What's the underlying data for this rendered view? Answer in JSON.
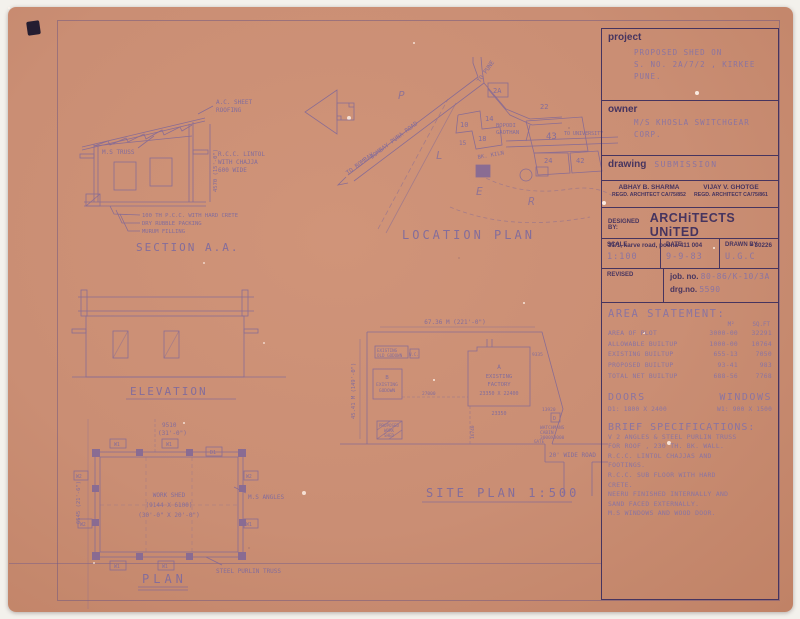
{
  "title_block": {
    "project": {
      "label": "project",
      "lines": [
        "PROPOSED SHED ON",
        "S. NO. 2A/7/2 , KIRKEE",
        "PUNE."
      ]
    },
    "owner": {
      "label": "owner",
      "lines": [
        "M/S KHOSLA SWITCHGEAR",
        "CORP."
      ]
    },
    "drawing": {
      "label": "drawing",
      "value": "SUBMISSION"
    },
    "architects": [
      {
        "name": "ABHAY B. SHARMA",
        "reg": "REGD. ARCHITECT CA/75/852"
      },
      {
        "name": "VIJAY V. GHOTGE",
        "reg": "REGD. ARCHITECT CA/75/861"
      }
    ],
    "designed_by": {
      "label": "DESIGNED BY:",
      "firm": "ARCHiTECTS UNiTED",
      "address": "31/1, karve road, poona 411 004",
      "phone": "• 30226"
    },
    "scale": {
      "label": "SCALE",
      "value": "1:100"
    },
    "date": {
      "label": "DATE",
      "value": "9-9-83"
    },
    "drawn_by": {
      "label": "DRAWN BY",
      "value": "U.G.C"
    },
    "revised_label": "REVISED",
    "job_no": {
      "label": "job. no.",
      "value": "80-86/K-10/3A"
    },
    "drg_no": {
      "label": "drg.no.",
      "value": "5590"
    }
  },
  "area_statement": {
    "title": "AREA STATEMENT:",
    "col_m2": "M²",
    "col_sqft": "SQ.FT",
    "rows": [
      {
        "label": "AREA OF PLOT",
        "m2": "3000-00",
        "sqft": "32291"
      },
      {
        "label": "ALLOWABLE BUILTUP",
        "m2": "1000-00",
        "sqft": "10764"
      },
      {
        "label": "EXISTING BUILTUP",
        "m2": "655-13",
        "sqft": "7050"
      },
      {
        "label": "PROPOSED BUILTUP",
        "m2": "93-41",
        "sqft": "983"
      },
      {
        "label": "TOTAL NET BUILTUP",
        "m2": "688-56",
        "sqft": "7768"
      }
    ]
  },
  "doors_windows": {
    "doors_title": "DOORS",
    "windows_title": "WINDOWS",
    "door_spec": "D1: 1800 X 2400",
    "window_spec": "W1: 900 X 1500"
  },
  "brief_specs": {
    "title": "BRIEF SPECIFICATIONS:",
    "lines": [
      "V 2 ANGLES & STEEL PURLIN TRUSS",
      "FOR ROOF , 230 TH. BK. WALL.",
      "R.C.C. LINTOL CHAJJAS AND",
      "FOOTINGS.",
      "R.C.C. SUB FLOOR WITH HARD",
      "CRETE.",
      "NEERU FINISHED INTERNALLY AND",
      "SAND FACED EXTERNALLY.",
      "M.S WINDOWS AND WOOD DOOR."
    ]
  },
  "drawings": {
    "section": {
      "title": "SECTION A.A.",
      "roofing": [
        "A.C. SHEET",
        "ROOFING"
      ],
      "truss": "M.S TRUSS",
      "lintol": [
        "R.C.C. LINTOL",
        "WITH CHAJJA",
        "600 WIDE"
      ],
      "floor_notes": [
        "100 TH P.C.C. WITH HARD CRETE",
        "DRY RUBBLE PACKING",
        "MURUM FILLING"
      ],
      "dim_height": "4570 (15'-0\")"
    },
    "location": {
      "title": "LOCATION PLAN",
      "road": "BOMBAY PUNA ROAD",
      "to_pune": "TO PUNE",
      "to_bombay": "TO BOMBAY",
      "to_university": "TO UNIVERSITY",
      "gaothan": [
        "BOPODI",
        "GAOTHAN"
      ],
      "kiln": "BK. KILN",
      "plots": [
        "2A",
        "10",
        "14",
        "18",
        "15",
        "22",
        "43",
        "24",
        "42"
      ],
      "letters": [
        "P",
        "L",
        "E",
        "R"
      ]
    },
    "elevation": {
      "title": "ELEVATION"
    },
    "plan": {
      "title": "PLAN",
      "dim_top": [
        "9510",
        "(31'-0\")"
      ],
      "dim_left": "6545 (21'-6\")",
      "room": [
        "WORK SHED",
        "(9144 X 6100)",
        "(30'-0\" X 20'-0\")"
      ],
      "ms_angles": "M.S ANGLES",
      "purlin": "STEEL PURLIN TRUSS",
      "door": "D1",
      "w1": "W1",
      "w2": "W2"
    },
    "site": {
      "title": "SITE PLAN 1:500",
      "dim_top": "67.36 M (221'-0\")",
      "dim_left": "45.41 M (149'-0\")",
      "factory": [
        "A",
        "EXISTING",
        "FACTORY",
        "23350 X 22400"
      ],
      "factory_dim_bottom": "23350",
      "factory_dim_right": "9335",
      "godown": [
        "B",
        "EXISTING",
        "GODOWN"
      ],
      "old_godown": [
        "EXISTING",
        "OLD GODOWN"
      ],
      "wc": "W.C.",
      "proposed": [
        "PROPOSED",
        "WORK",
        "SHED"
      ],
      "watchman": [
        "D",
        "WATCHMANS",
        "CABIN",
        "3000X3000"
      ],
      "gate": "GATE",
      "road": "20' WIDE ROAD",
      "dim_27000": "27000",
      "dim_16740": "16740",
      "dim_13920": "13920"
    }
  }
}
